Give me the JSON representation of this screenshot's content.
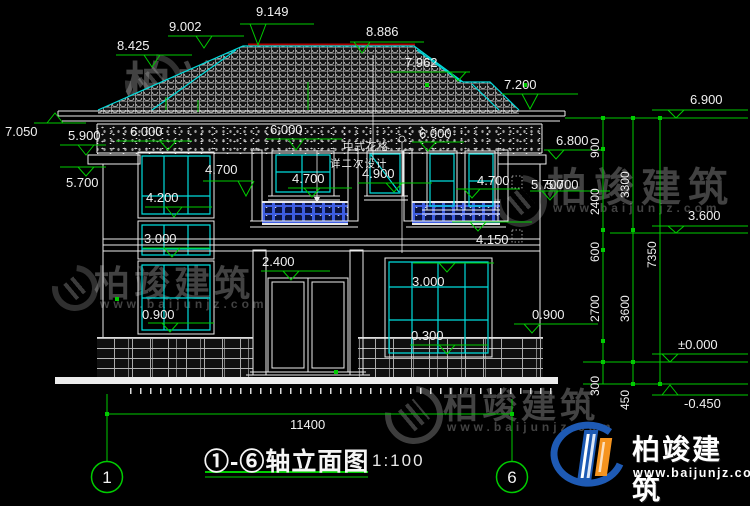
{
  "title": {
    "text": "①-⑥轴立面图",
    "scale": "1:100"
  },
  "grid": {
    "left": "1",
    "right": "6"
  },
  "note": {
    "line1": "中式花格",
    "line2": "详二次设计"
  },
  "watermark": {
    "brand": "柏竣建筑",
    "url": "www.baijunjz.com"
  },
  "logo": {
    "brand": "柏竣建筑",
    "url": "www.baijunjz.com"
  },
  "colors": {
    "cad_green": "#00cc00",
    "cad_cyan": "#00dcdc",
    "ridge_red": "#b00000",
    "railing_blue": "#3d5de2"
  },
  "dims": {
    "total": "11400",
    "d900": "900",
    "d2400": "2400",
    "d600": "600",
    "d2700": "2700",
    "d300": "300",
    "d3300": "3300",
    "d3600": "3600",
    "d450": "450",
    "d7350": "7350"
  },
  "levels": {
    "l8425": "8.425",
    "l9002": "9.002",
    "l9149": "9.149",
    "l8886": "8.886",
    "l7962": "7.962",
    "l7200": "7.200",
    "l7050": "7.050",
    "l6900": "6.900",
    "l6800": "6.800",
    "l6000a": "6.000",
    "l6000b": "6.000",
    "l6000c": "6.000",
    "l5900": "5.900",
    "l5700a": "5.700",
    "l5700b": "5.700",
    "l5700c": "5.700",
    "l4900": "4.900",
    "l4700a": "4.700",
    "l4700b": "4.700",
    "l4700c": "4.700",
    "l4200": "4.200",
    "l4150": "4.150",
    "l3600": "3.600",
    "l3000a": "3.000",
    "l3000b": "3.000",
    "l2400": "2.400",
    "l0900a": "0.900",
    "l0900b": "0.900",
    "l0300": "0.300",
    "l0000": "±0.000",
    "lneg0450": "-0.450"
  }
}
